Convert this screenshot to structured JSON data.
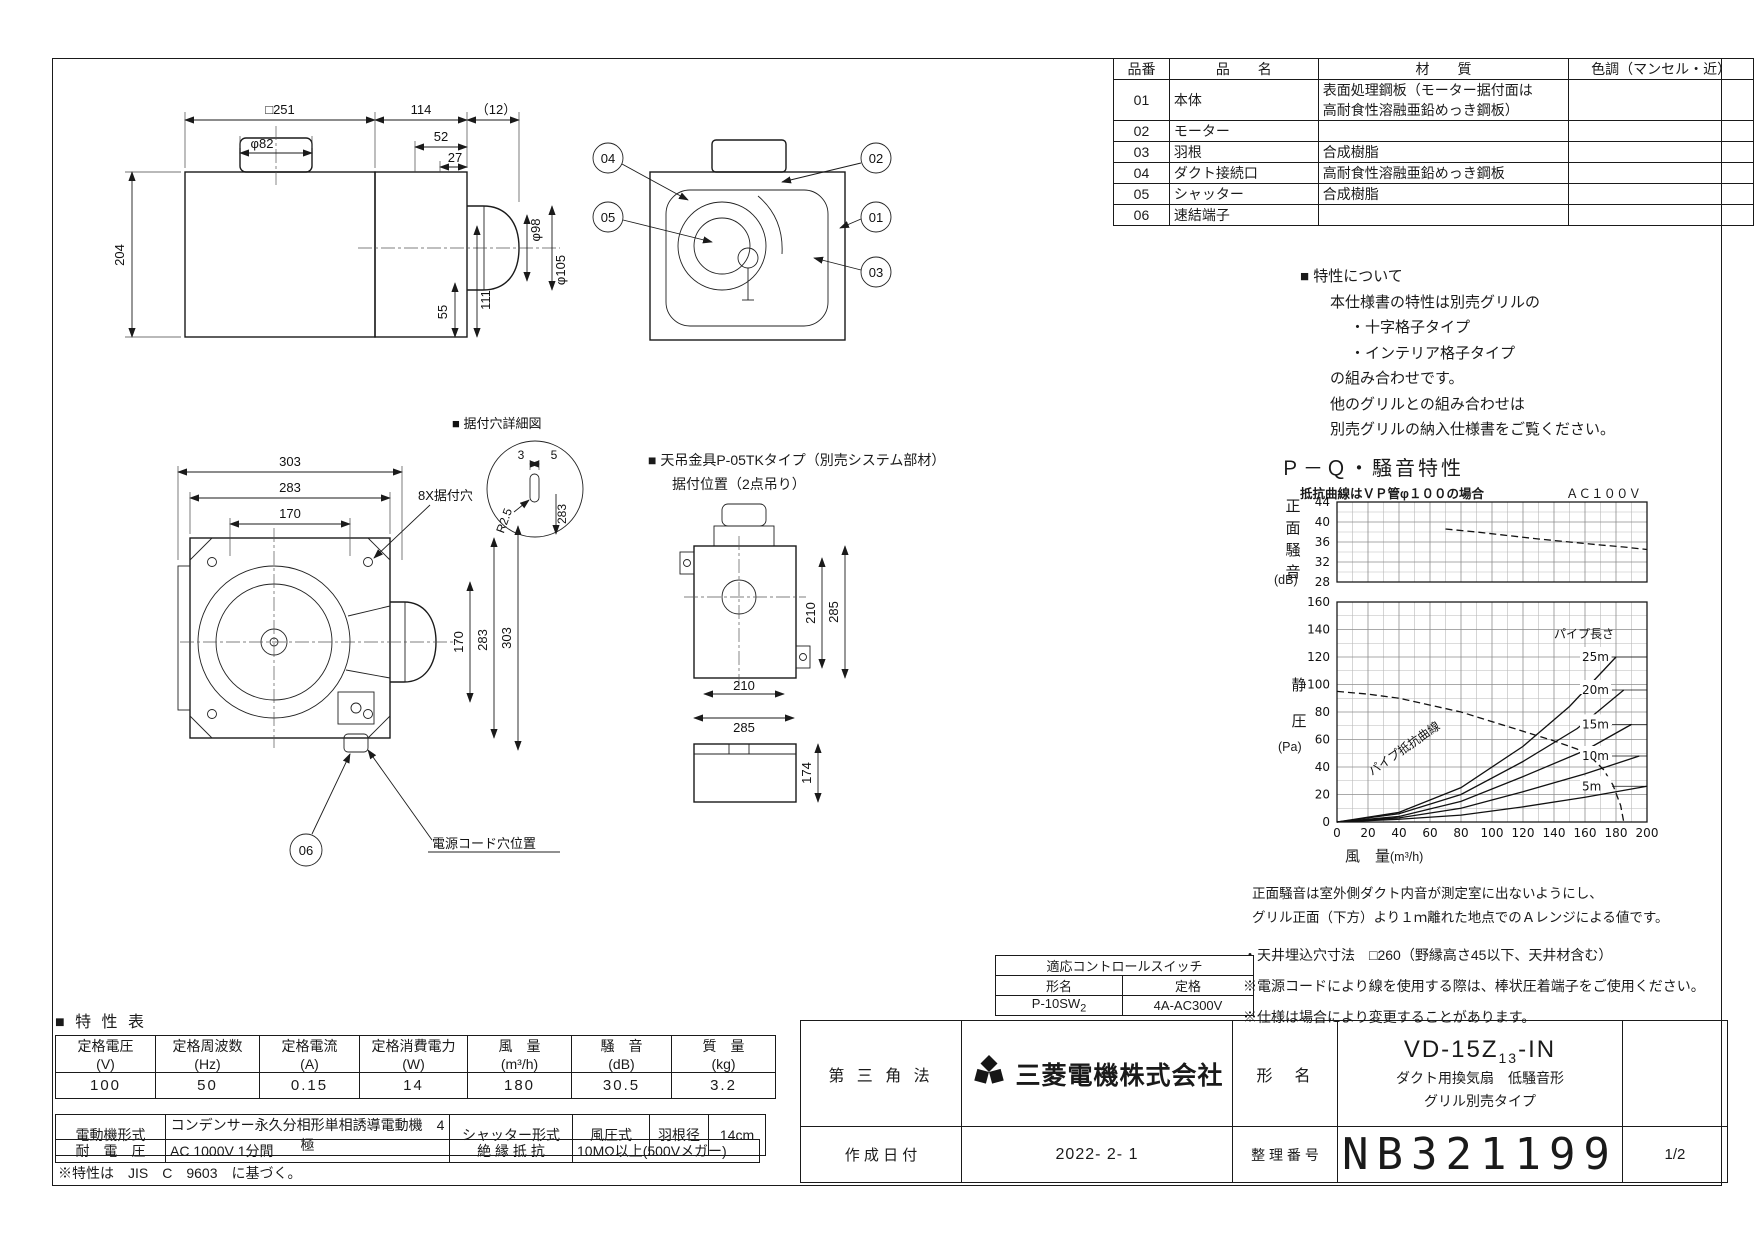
{
  "parts_table": {
    "headers": {
      "no": "品番",
      "name": "品　　名",
      "material": "材　　質",
      "color": "色調（マンセル・近）"
    },
    "rows": [
      {
        "no": "01",
        "name": "本体",
        "material": "表面処理鋼板（モーター据付面は\n高耐食性溶融亜鉛めっき鋼板）",
        "color": ""
      },
      {
        "no": "02",
        "name": "モーター",
        "material": "",
        "color": ""
      },
      {
        "no": "03",
        "name": "羽根",
        "material": "合成樹脂",
        "color": ""
      },
      {
        "no": "04",
        "name": "ダクト接続口",
        "material": "高耐食性溶融亜鉛めっき鋼板",
        "color": ""
      },
      {
        "no": "05",
        "name": "シャッター",
        "material": "合成樹脂",
        "color": ""
      },
      {
        "no": "06",
        "name": "速結端子",
        "material": "",
        "color": ""
      }
    ]
  },
  "feature_note": {
    "title": "■ 特性について",
    "lines": [
      "本仕様書の特性は別売グリルの",
      "・十字格子タイプ",
      "・インテリア格子タイプ",
      "の組み合わせです。",
      "他のグリルとの組み合わせは",
      "別売グリルの納入仕様書をご覧ください。"
    ]
  },
  "pq_chart": {
    "title": "Ｐ－Ｑ・騒音特性",
    "condition_note": "抵抗曲線はＶＰ管φ１００の場合",
    "power_note": "ＡＣ１００Ｖ",
    "noise_axis_label": "正面騒音",
    "noise_axis_unit": "(dB)",
    "pressure_axis_label": "静圧",
    "pressure_axis_unit": "(Pa)",
    "flow_axis_label": "風　量",
    "flow_axis_unit": "(m³/h)",
    "pipe_length_label": "パイプ長さ",
    "pipe_resistance_label": "パイプ抵抗曲線",
    "notes": [
      "正面騒音は室外側ダクト内音が測定室に出ないようにし、",
      "グリル正面（下方）より１ｍ離れた地点でのＡレンジによる値です。"
    ]
  },
  "chart_data": [
    {
      "type": "line",
      "title": "正面騒音特性",
      "xlabel": "風量(m³/h)",
      "ylabel": "正面騒音(dB)",
      "xlim": [
        0,
        200
      ],
      "ylim": [
        28,
        44
      ],
      "x_major": 20,
      "x_minor": 10,
      "y_major": 4,
      "y_minor": 2,
      "grid": true,
      "legend_position": "none",
      "series": [
        {
          "name": "正面騒音",
          "style": "dashed",
          "points": [
            [
              70,
              38.6
            ],
            [
              90,
              38.0
            ],
            [
              110,
              37.3
            ],
            [
              130,
              36.6
            ],
            [
              150,
              36.0
            ],
            [
              170,
              35.4
            ],
            [
              185,
              35.0
            ],
            [
              200,
              34.5
            ]
          ]
        }
      ]
    },
    {
      "type": "line",
      "title": "P-Q特性",
      "xlabel": "風量(m³/h)",
      "ylabel": "静圧(Pa)",
      "xlim": [
        0,
        200
      ],
      "ylim": [
        0,
        160
      ],
      "x_major": 20,
      "x_minor": 10,
      "y_major": 20,
      "y_minor": 10,
      "grid": true,
      "legend_position": "inline-right",
      "series": [
        {
          "name": "P-Q曲線",
          "style": "dashed",
          "points": [
            [
              0,
              95
            ],
            [
              20,
              93
            ],
            [
              40,
              90
            ],
            [
              60,
              85
            ],
            [
              80,
              80
            ],
            [
              100,
              73
            ],
            [
              120,
              66
            ],
            [
              140,
              59
            ],
            [
              155,
              53
            ],
            [
              165,
              46
            ],
            [
              172,
              38
            ],
            [
              178,
              27
            ],
            [
              183,
              12
            ],
            [
              185,
              0
            ]
          ]
        },
        {
          "name": "パイプ長さ 25m",
          "label": "25m",
          "style": "solid",
          "points": [
            [
              0,
              0
            ],
            [
              40,
              7
            ],
            [
              80,
              25
            ],
            [
              120,
              55
            ],
            [
              150,
              84
            ],
            [
              180,
              120
            ]
          ]
        },
        {
          "name": "パイプ長さ 20m",
          "label": "20m",
          "style": "solid",
          "points": [
            [
              0,
              0
            ],
            [
              40,
              6
            ],
            [
              80,
              20
            ],
            [
              120,
              44
            ],
            [
              155,
              68
            ],
            [
              185,
              96
            ]
          ]
        },
        {
          "name": "パイプ長さ 15m",
          "label": "15m",
          "style": "solid",
          "points": [
            [
              0,
              0
            ],
            [
              40,
              4
            ],
            [
              80,
              15
            ],
            [
              120,
              33
            ],
            [
              160,
              52
            ],
            [
              190,
              71
            ]
          ]
        },
        {
          "name": "パイプ長さ 10m",
          "label": "10m",
          "style": "solid",
          "points": [
            [
              0,
              0
            ],
            [
              40,
              3
            ],
            [
              80,
              10
            ],
            [
              120,
              22
            ],
            [
              160,
              35
            ],
            [
              195,
              48
            ]
          ]
        },
        {
          "name": "パイプ長さ 5m",
          "label": "5m",
          "style": "solid",
          "points": [
            [
              0,
              0
            ],
            [
              40,
              2
            ],
            [
              80,
              5
            ],
            [
              120,
              11
            ],
            [
              160,
              18
            ],
            [
              200,
              26
            ]
          ]
        }
      ]
    }
  ],
  "install_notes": [
    "・天井埋込穴寸法　□260（野縁高さ45以下、天井材含む）",
    "※電源コードにより線を使用する際は、棒状圧着端子をご使用ください。",
    "※仕様は場合により変更することがあります。"
  ],
  "control_switch": {
    "title": "適応コントロールスイッチ",
    "model_header": "形名",
    "rating_header": "定格",
    "model": "P-10SW",
    "model_sub": "2",
    "rating": "4A-AC300V"
  },
  "spec_table": {
    "section_title": "■ 特 性 表",
    "headers": [
      "定格電圧\n(V)",
      "定格周波数\n(Hz)",
      "定格電流\n(A)",
      "定格消費電力\n(W)",
      "風　量\n(m³/h)",
      "騒　音\n(dB)",
      "質　量\n(kg)"
    ],
    "values": [
      "100",
      "50",
      "0.15",
      "14",
      "180",
      "30.5",
      "3.2"
    ],
    "motor_label": "電動機形式",
    "motor_value": "コンデンサー永久分相形単相誘導電動機　4極",
    "shutter_label": "シャッター形式",
    "shutter_value": "風圧式",
    "blade_label": "羽根径",
    "blade_value": "14cm",
    "withstand_label": "耐　電　圧",
    "withstand_value": "AC 1000V 1分間",
    "insulation_label": "絶 縁 抵 抗",
    "insulation_value": "10MΩ以上(500Vメガー)",
    "footnote": "※特性は　JIS　C　9603　に基づく。"
  },
  "title_block": {
    "projection": "第 三 角 法",
    "company": "三菱電機株式会社",
    "model_label": "形　名",
    "model_prefix": "VD-15Z",
    "model_sub": "13",
    "model_suffix": "-IN",
    "model_desc1": "ダクト用換気扇　低騒音形",
    "model_desc2": "グリル別売タイプ",
    "date_label": "作 成 日 付",
    "date_value": "2022- 2- 1",
    "number_label": "整 理 番 号",
    "number_value": "NB321199",
    "page": "1/2"
  },
  "drawing": {
    "front_view": {
      "dim_width": "□251",
      "dim_cap": "φ82",
      "dim_height": "204",
      "dim_depth": "114",
      "dim_ext": "（12）",
      "dim_52": "52",
      "dim_27": "27",
      "dim_duct": "φ98",
      "dim_duct_outer": "φ105",
      "dim_55": "55",
      "dim_111": "111"
    },
    "balloons": {
      "b01": "01",
      "b02": "02",
      "b03": "03",
      "b04": "04",
      "b05": "05",
      "b06": "06"
    },
    "bottom_view": {
      "dim_w303": "303",
      "dim_w283": "283",
      "dim_w170": "170",
      "dim_h170": "170",
      "dim_h283": "283",
      "dim_h303": "303",
      "mount_hole_label": "8X据付穴",
      "detail_title": "■ 据付穴詳細図",
      "dim_3": "3",
      "dim_5": "5",
      "dim_r": "R2.5",
      "dim_283": "283",
      "cord_hole_label": "電源コード穴位置"
    },
    "bracket_view": {
      "title": "■ 天吊金具P-05TKタイプ（別売システム部材）",
      "subtitle": "据付位置（2点吊り）",
      "dim_v210": "210",
      "dim_v285": "285",
      "dim_h210": "210",
      "dim_h285": "285",
      "dim_174": "174"
    }
  }
}
